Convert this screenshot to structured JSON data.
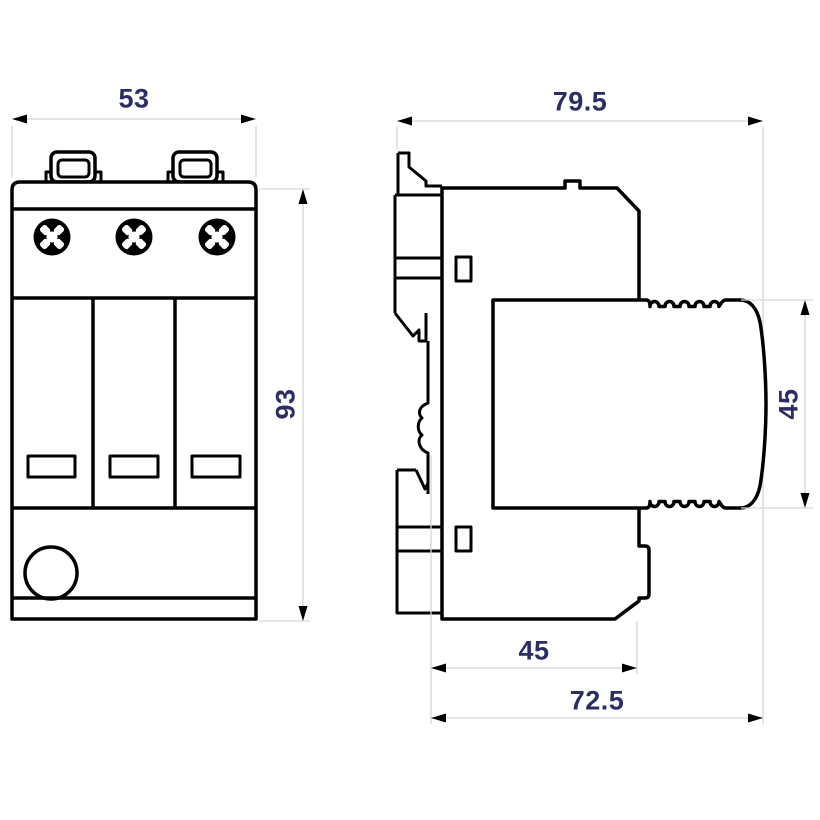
{
  "drawing": {
    "title": "surge-protection-device-dimension-drawing",
    "front_view": {
      "width": "53",
      "height": "93"
    },
    "side_view": {
      "overall_depth": "79.5",
      "module_height": "45",
      "base_depth": "45",
      "depth_with_module": "72.5"
    },
    "colors": {
      "outline": "#000000",
      "dimension_line": "#d6d6d6",
      "dimension_text": "#2b2d63",
      "background": "#ffffff"
    }
  }
}
